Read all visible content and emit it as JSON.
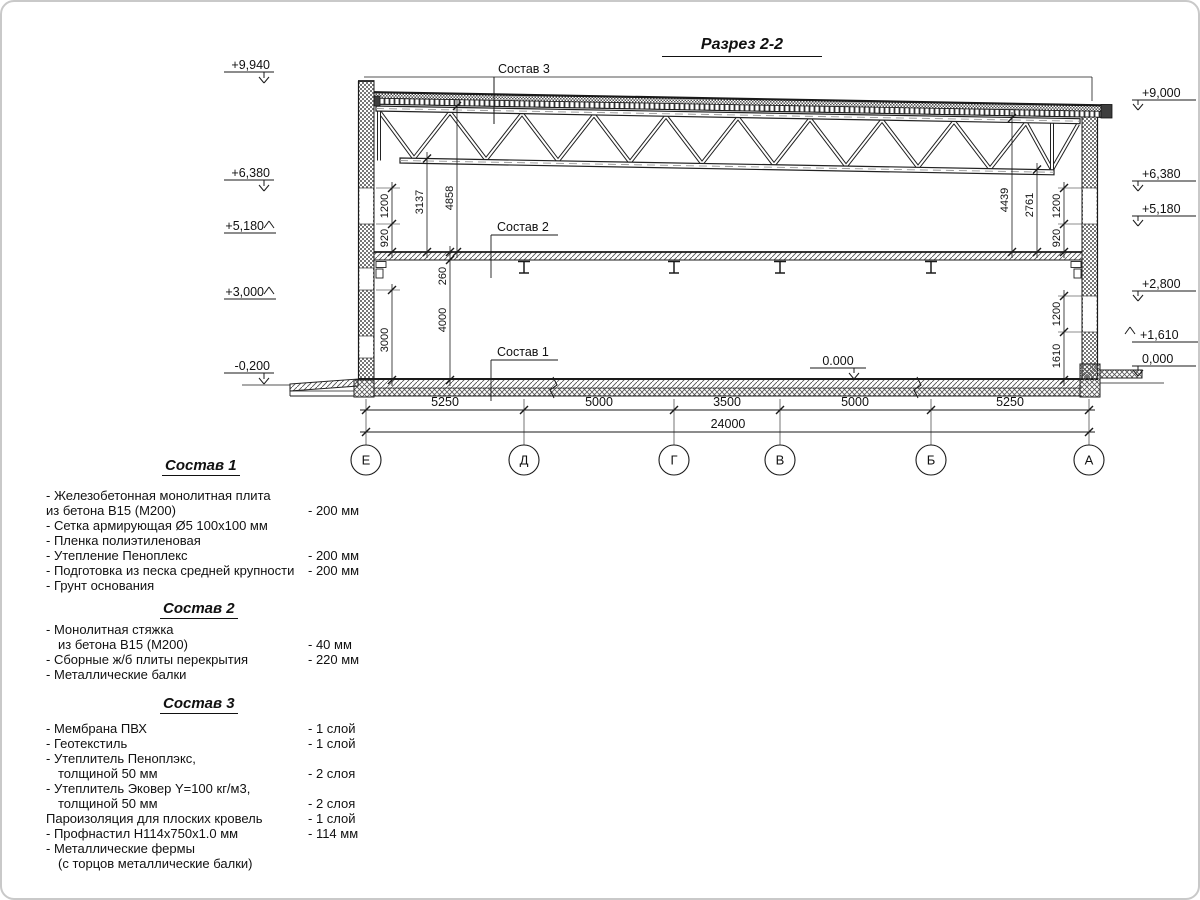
{
  "title": "Разрез 2-2",
  "labels": {
    "sostav1": "Состав 1",
    "sostav2": "Состав 2",
    "sostav3": "Состав 3"
  },
  "elevations": {
    "left": [
      "+9,940",
      "+6,380",
      "+5,180",
      "+3,000",
      "-0,200"
    ],
    "right": [
      "+9,000",
      "+6,380",
      "+5,180",
      "+2,800",
      "+1,610",
      "0,000"
    ],
    "floor": "0.000"
  },
  "dims": {
    "vertical_left": [
      "1200",
      "920",
      "3137",
      "4858",
      "260",
      "4000",
      "3000"
    ],
    "vertical_right": [
      "4439",
      "2761",
      "1200",
      "920",
      "1200",
      "1610"
    ],
    "bottom": [
      "5250",
      "5000",
      "3500",
      "5000",
      "5250"
    ],
    "total": "24000"
  },
  "axes": [
    "Е",
    "Д",
    "Г",
    "В",
    "Б",
    "А"
  ],
  "compositions": [
    {
      "heading": "Состав 1",
      "items": [
        {
          "text": "- Железобетонная  монолитная плита",
          "value": ""
        },
        {
          "text": "из бетона  В15 (М200)",
          "value": "- 200 мм"
        },
        {
          "text": "- Сетка армирующая Ø5 100х100 мм",
          "value": ""
        },
        {
          "text": "- Пленка полиэтиленовая",
          "value": ""
        },
        {
          "text": "- Утепление Пеноплекс",
          "value": "- 200 мм"
        },
        {
          "text": "- Подготовка из песка средней  крупности",
          "value": "- 200 мм"
        },
        {
          "text": "- Грунт основания",
          "value": ""
        }
      ]
    },
    {
      "heading": "Состав 2",
      "items": [
        {
          "text": "- Монолитная стяжка",
          "value": ""
        },
        {
          "text": "из бетона В15 (М200)",
          "value": "- 40 мм"
        },
        {
          "text": "- Сборные ж/б плиты перекрытия",
          "value": "- 220 мм"
        },
        {
          "text": "- Металлические балки",
          "value": ""
        }
      ]
    },
    {
      "heading": "Состав 3",
      "items": [
        {
          "text": "- Мембрана ПВХ",
          "value": "- 1 слой"
        },
        {
          "text": "- Геотекстиль",
          "value": "- 1 слой"
        },
        {
          "text": "- Утеплитель Пеноплэкс,",
          "value": ""
        },
        {
          "text": "толщиной 50 мм",
          "value": "- 2 слоя"
        },
        {
          "text": "- Утеплитель Эковер Y=100 кг/м3,",
          "value": ""
        },
        {
          "text": "толщиной 50 мм",
          "value": "- 2 слоя"
        },
        {
          "text": "Пароизоляция для плоских кровель",
          "value": "- 1 слой"
        },
        {
          "text": "- Профнастил Н114х750х1.0 мм",
          "value": "- 114 мм"
        },
        {
          "text": "- Металлические фермы",
          "value": ""
        },
        {
          "text": "(с торцов металлические балки)",
          "value": ""
        }
      ]
    }
  ]
}
